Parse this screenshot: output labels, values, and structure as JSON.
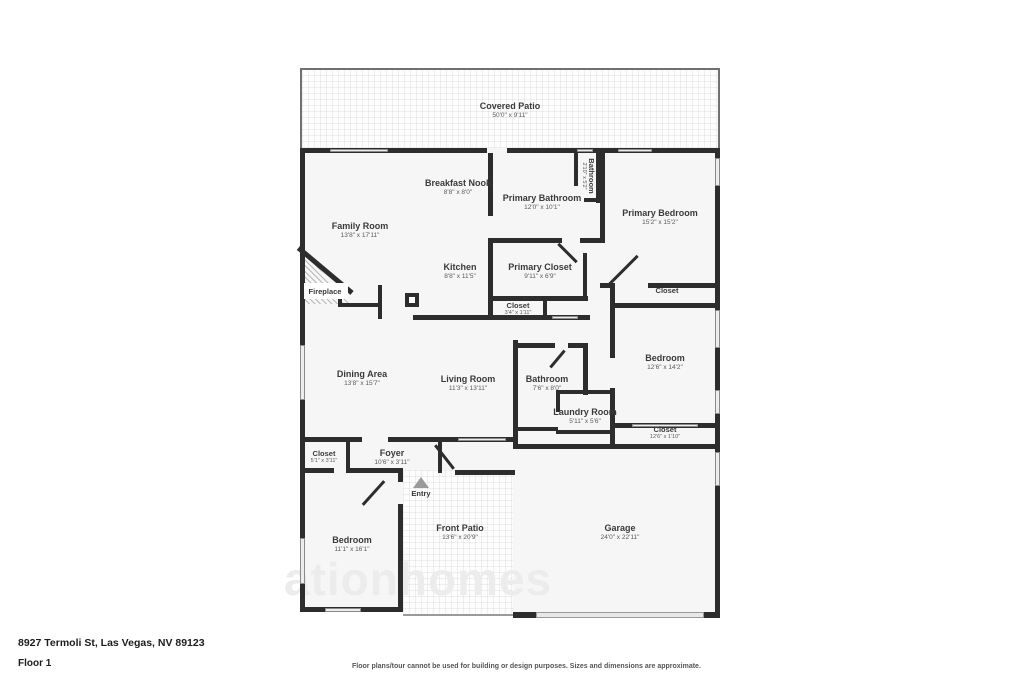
{
  "meta": {
    "type": "floor-plan"
  },
  "watermark": "ationhomes",
  "footer": {
    "address": "8927 Termoli St, Las Vegas, NV 89123",
    "floor": "Floor 1",
    "disclaimer": "Floor plans/tour cannot be used for building or design purposes. Sizes and dimensions are approximate."
  },
  "colors": {
    "wall": "#2d2d2d",
    "room_fill": "#f6f6f6",
    "label_text": "#3a3a3a",
    "dims_text": "#5a5a5a"
  },
  "rooms": {
    "covered_patio": {
      "name": "Covered Patio",
      "dims": "50'0\" x 9'11\""
    },
    "breakfast_nook": {
      "name": "Breakfast Nook",
      "dims": "8'8\" x 8'0\""
    },
    "primary_bathroom": {
      "name": "Primary Bathroom",
      "dims": "12'0\" x 10'1\""
    },
    "wc_bathroom": {
      "name": "Bathroom",
      "dims": "2'10\" x 5'2\""
    },
    "primary_bedroom": {
      "name": "Primary Bedroom",
      "dims": "15'2\" x 15'2\""
    },
    "family_room": {
      "name": "Family Room",
      "dims": "13'8\" x 17'11\""
    },
    "kitchen": {
      "name": "Kitchen",
      "dims": "8'8\" x 11'5\""
    },
    "primary_closet": {
      "name": "Primary Closet",
      "dims": "9'11\" x 6'9\""
    },
    "fireplace": {
      "name": "Fireplace"
    },
    "closet_primary": {
      "name": "Closet"
    },
    "closet_kitchen": {
      "name": "Closet",
      "dims": "3'4\" x 1'11\""
    },
    "bedroom_right": {
      "name": "Bedroom",
      "dims": "12'6\" x 14'2\""
    },
    "closet_bedroom_right": {
      "name": "Closet",
      "dims": "12'6\" x 1'10\""
    },
    "dining_area": {
      "name": "Dining Area",
      "dims": "13'8\" x 15'7\""
    },
    "living_room": {
      "name": "Living Room",
      "dims": "11'3\" x 13'11\""
    },
    "bathroom": {
      "name": "Bathroom",
      "dims": "7'6\" x 8'0\""
    },
    "laundry_room": {
      "name": "Laundry Room",
      "dims": "5'11\" x 5'6\""
    },
    "closet_hall": {
      "name": "Closet",
      "dims": "5'1\" x 3'11\""
    },
    "foyer": {
      "name": "Foyer",
      "dims": "10'6\" x 3'11\""
    },
    "entry": {
      "name": "Entry"
    },
    "bedroom_left": {
      "name": "Bedroom",
      "dims": "11'1\" x 16'1\""
    },
    "front_patio": {
      "name": "Front Patio",
      "dims": "13'6\" x 20'9\""
    },
    "garage": {
      "name": "Garage",
      "dims": "24'0\" x 22'11\""
    }
  }
}
